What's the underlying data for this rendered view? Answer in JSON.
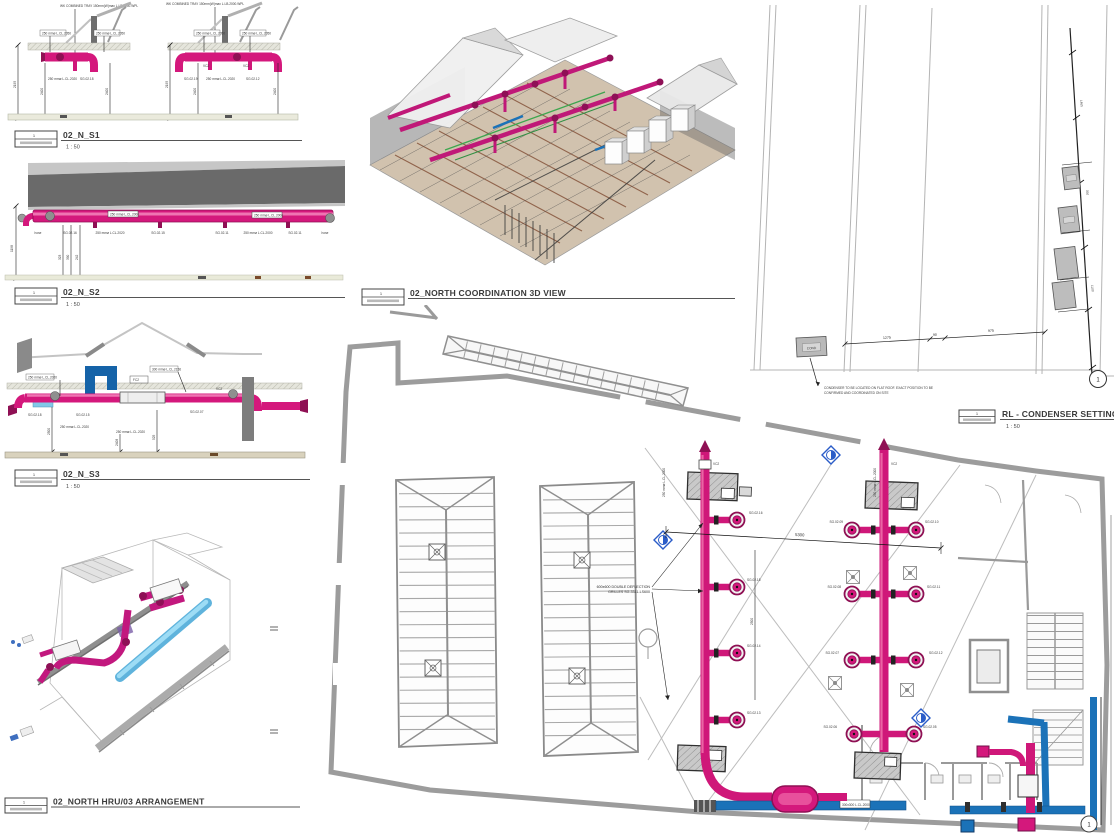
{
  "colors": {
    "duct_pink": "#d4187c",
    "duct_pink_dark": "#8f1054",
    "duct_blue": "#1b72b8",
    "duct_cyan": "#82c8e8",
    "wall_gray": "#9c9c9c",
    "marker_blue": "#2a5cc8"
  },
  "views": {
    "s1": {
      "title": "02_N_S1",
      "scale": "1 : 50",
      "ref": "1",
      "top_label_1": "WK COMBINED TRAY 150mm(W)max L.LB.2000.WPL",
      "top_label_2": "WK COMBINED TRAY 150mm(W)max L.LB.2000.WPL",
      "tag_1": "250 mmø L.CL.2050",
      "tag_2": "250 mmø L.CL.2050",
      "tag_3": "250 mmø L.CL.2050",
      "tag_4": "250 mmø L.CL.2050",
      "tag_5": "250 mmø L.CL.2020",
      "tag_6": "SG.02.18",
      "tag_7": "SG.02.19",
      "tag_8": "250 mmø L.CL.2020",
      "tag_9": "SG.02.12",
      "tag_10": "VC2",
      "tag_11": "VC2",
      "dim_1": "2195",
      "dim_2": "2400",
      "dim_3": "2400",
      "dim_4": "2195",
      "dim_5": "2400",
      "dim_6": "2400"
    },
    "s2": {
      "title": "02_N_S2",
      "scale": "1 : 50",
      "ref": "1",
      "duct_label_1": "250 mmø L.CL.2000",
      "duct_label_2": "250 mmø L.CL.2000",
      "tag_1": "hose",
      "tag_2": "SG.02.16",
      "tag_3": "250 mmø L.CL.2020",
      "tag_4": "SG.02.15",
      "tag_5": "SG.02.11",
      "tag_6": "250 mmø L.CL.2000",
      "tag_7": "SG.02.11",
      "tag_8": "hose",
      "dim_1": "1198",
      "dim_2": "323",
      "dim_3": "390",
      "dim_4": "242"
    },
    "s3": {
      "title": "02_N_S3",
      "scale": "1 : 50",
      "ref": "1",
      "tag_1": "250 mmø L.CL.2020",
      "tag_2": "300 mmø L.CL.2156",
      "tag_3": "VC2",
      "tag_4": "SG.02.18",
      "tag_5": "SG.02.15",
      "tag_6": "250 mmø L.CL.2020",
      "tag_7": "250 mmø L.CL.2020",
      "tag_8": "SG.02.07",
      "tag_9": "FC2",
      "dim_1": "2500",
      "dim_2": "2408",
      "dim_3": "525"
    },
    "coord3d": {
      "title": "02_NORTH COORDINATION 3D VIEW",
      "ref": "1"
    },
    "condenser": {
      "title": "RL - CONDENSER SETTING-O",
      "scale": "1 : 50",
      "ref": "1",
      "marker": "1",
      "unit_label": "COND",
      "note_1": "CONDENSER TO BE LOCATED ON FLAT ROOF. EXACT POSITION TO BE",
      "note_2": "CONFIRMED AND COORDINATED ON SITE",
      "dim_1": "1275",
      "dim_2": "90",
      "dim_3": "975",
      "dim_4": "1465",
      "dim_5": "350",
      "dim_6": "1100"
    },
    "hru3d": {
      "title": "02_NORTH HRU/03 ARRANGEMENT",
      "ref": "1"
    },
    "plan": {
      "grille_note_1": "600x600 DOUBLE DEFLECTION",
      "grille_note_2": "GRILLES SG-3311-LS600",
      "dim_main": "5300",
      "dim_side": "2500",
      "marker": "1",
      "duct_label": "300x300 L.CL.2000",
      "code_1": "SG.02.16",
      "code_2": "SG.02.15",
      "code_3": "SG.02.14",
      "code_4": "SG.02.13",
      "code_5": "SG.02.09",
      "code_6": "SG.02.10",
      "code_7": "SG.02.08",
      "code_8": "SG.02.11",
      "code_9": "SG.02.07",
      "code_10": "SG.02.12",
      "code_11": "SG.02.06",
      "code_12": "SG.02.05",
      "tag_1": "250 mmø L.CL.2000",
      "tag_2": "250 mmø L.CL.2000",
      "tag_3": "VC2",
      "tag_4": "VC2"
    }
  }
}
